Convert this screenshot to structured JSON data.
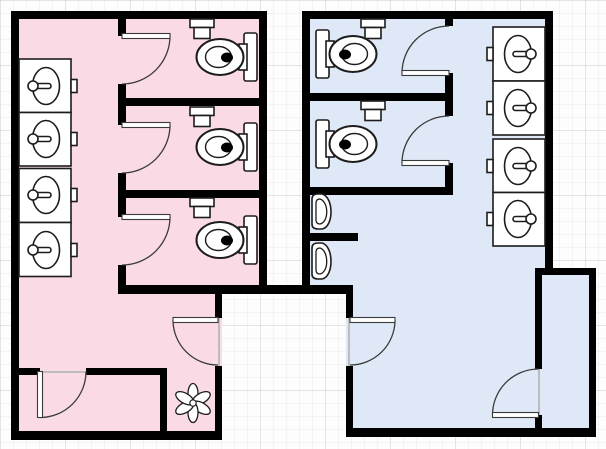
{
  "canvas": {
    "w": 606,
    "h": 449
  },
  "palette": {
    "wall": "#000000",
    "womens_floor": "#FADBE5",
    "mens_floor": "#DEE8F6",
    "fixture_fill": "#ffffff",
    "fixture_stroke": "#1c1c1c",
    "door_stroke": "#3a3a3a",
    "threshold": "#bdbdbd",
    "seat_dot": "#000000"
  },
  "rooms": [
    {
      "name": "womens-restroom-floor",
      "fill": "womens_floor",
      "rects": [
        [
          11,
          11,
          256,
          283
        ],
        [
          11,
          285,
          211,
          155
        ]
      ]
    },
    {
      "name": "mens-restroom-floor",
      "fill": "mens_floor",
      "rects": [
        [
          302,
          11,
          251,
          283
        ],
        [
          346,
          285,
          250,
          152
        ],
        [
          535,
          268,
          61,
          169
        ]
      ]
    }
  ],
  "walls": [
    [
      11,
      11,
      256,
      8
    ],
    [
      11,
      11,
      8,
      429
    ],
    [
      11,
      431,
      211,
      9
    ],
    [
      259,
      11,
      8,
      283
    ],
    [
      118,
      19,
      8,
      17
    ],
    [
      118,
      84,
      8,
      41
    ],
    [
      118,
      173,
      8,
      44
    ],
    [
      118,
      265,
      8,
      29
    ],
    [
      118,
      98,
      141,
      8
    ],
    [
      118,
      190,
      141,
      8
    ],
    [
      118,
      285,
      235,
      9
    ],
    [
      215,
      285,
      7,
      33
    ],
    [
      215,
      366,
      7,
      74
    ],
    [
      11,
      368,
      29,
      7
    ],
    [
      86,
      368,
      81,
      7
    ],
    [
      160,
      368,
      7,
      72
    ],
    [
      302,
      11,
      251,
      8
    ],
    [
      302,
      11,
      8,
      283
    ],
    [
      545,
      11,
      8,
      260
    ],
    [
      445,
      19,
      8,
      7
    ],
    [
      445,
      73,
      8,
      28
    ],
    [
      445,
      101,
      8,
      15
    ],
    [
      445,
      163,
      8,
      32
    ],
    [
      310,
      93,
      143,
      8
    ],
    [
      310,
      187,
      143,
      8
    ],
    [
      302,
      233,
      56,
      8
    ],
    [
      346,
      285,
      7,
      33
    ],
    [
      346,
      366,
      7,
      71
    ],
    [
      346,
      428,
      250,
      9
    ],
    [
      535,
      270,
      7,
      99
    ],
    [
      535,
      415,
      7,
      14
    ],
    [
      535,
      268,
      61,
      7
    ],
    [
      589,
      268,
      7,
      169
    ]
  ],
  "thresholds": [
    [
      218,
      318,
      2,
      48
    ],
    [
      348,
      318,
      2,
      48
    ],
    [
      40,
      371,
      46,
      2
    ],
    [
      538,
      369,
      2,
      46
    ]
  ],
  "doors": [
    {
      "name": "womens-stall-1-door",
      "leaf": [
        122,
        33.5,
        48,
        5
      ],
      "arc": {
        "sx": 170,
        "sy": 36,
        "r": 48,
        "ex": 122,
        "ey": 84,
        "sweep": 1
      }
    },
    {
      "name": "womens-stall-2-door",
      "leaf": [
        122,
        122.5,
        48,
        5
      ],
      "arc": {
        "sx": 170,
        "sy": 125,
        "r": 48,
        "ex": 122,
        "ey": 173,
        "sweep": 1
      }
    },
    {
      "name": "womens-stall-3-door",
      "leaf": [
        122,
        214.5,
        48,
        5
      ],
      "arc": {
        "sx": 170,
        "sy": 217,
        "r": 48,
        "ex": 122,
        "ey": 265,
        "sweep": 1
      }
    },
    {
      "name": "mens-stall-1-door",
      "leaf": [
        402,
        70.5,
        47,
        5
      ],
      "arc": {
        "sx": 402,
        "sy": 73,
        "r": 47,
        "ex": 449,
        "ey": 26,
        "sweep": 1
      }
    },
    {
      "name": "mens-stall-2-door",
      "leaf": [
        402,
        160.5,
        47,
        5
      ],
      "arc": {
        "sx": 402,
        "sy": 163,
        "r": 47,
        "ex": 449,
        "ey": 116,
        "sweep": 1
      }
    },
    {
      "name": "womens-entrance-door",
      "leaf": [
        173,
        317.5,
        45,
        5
      ],
      "arc": {
        "sx": 173,
        "sy": 320,
        "r": 45,
        "ex": 218,
        "ey": 365,
        "sweep": 0
      }
    },
    {
      "name": "mens-entrance-door",
      "leaf": [
        350,
        317.5,
        45,
        5
      ],
      "arc": {
        "sx": 395,
        "sy": 320,
        "r": 45,
        "ex": 350,
        "ey": 365,
        "sweep": 1
      }
    },
    {
      "name": "womens-closet-door",
      "leaf": [
        37.5,
        371.5,
        5,
        46
      ],
      "arc": {
        "sx": 40,
        "sy": 417.5,
        "r": 46,
        "ex": 86,
        "ey": 371.5,
        "sweep": 0
      }
    },
    {
      "name": "mens-closet-door",
      "leaf": [
        492.5,
        412.5,
        46,
        5
      ],
      "arc": {
        "sx": 492.5,
        "sy": 415,
        "r": 46,
        "ex": 538.5,
        "ey": 369,
        "sweep": 1
      }
    }
  ],
  "sinks": [
    {
      "box": [
        19,
        59,
        52,
        53.5
      ],
      "cy": 86,
      "side": "left"
    },
    {
      "box": [
        19,
        112.5,
        52,
        53.5
      ],
      "cy": 139,
      "side": "left"
    },
    {
      "box": [
        19,
        168.5,
        52,
        54
      ],
      "cy": 195,
      "side": "left"
    },
    {
      "box": [
        19,
        222.5,
        52,
        54
      ],
      "cy": 250,
      "side": "left"
    },
    {
      "box": [
        493,
        27,
        52,
        54
      ],
      "cy": 54,
      "side": "right"
    },
    {
      "box": [
        493,
        81,
        52,
        54
      ],
      "cy": 108,
      "side": "right"
    },
    {
      "box": [
        493,
        139,
        52,
        53.5
      ],
      "cy": 166,
      "side": "right"
    },
    {
      "box": [
        493,
        192.5,
        52,
        53.5
      ],
      "cy": 219,
      "side": "right"
    }
  ],
  "toilets": [
    {
      "cx": 220,
      "cy": 57,
      "side": "right"
    },
    {
      "cx": 220,
      "cy": 147,
      "side": "right"
    },
    {
      "cx": 220,
      "cy": 240,
      "side": "right"
    },
    {
      "cx": 353,
      "cy": 54,
      "side": "left"
    },
    {
      "cx": 353,
      "cy": 144,
      "side": "left"
    }
  ],
  "urinals": [
    {
      "x": 310,
      "y": 193,
      "w": 24,
      "h": 37
    },
    {
      "x": 310,
      "y": 242,
      "w": 24,
      "h": 38
    }
  ],
  "flush_valves": [
    {
      "cx": 202,
      "y": 19
    },
    {
      "cx": 202,
      "y": 107
    },
    {
      "cx": 202,
      "y": 198
    },
    {
      "cx": 373,
      "y": 19
    },
    {
      "cx": 373,
      "y": 101
    }
  ],
  "plants": [
    {
      "cx": 193,
      "cy": 403,
      "petals": 6
    }
  ]
}
